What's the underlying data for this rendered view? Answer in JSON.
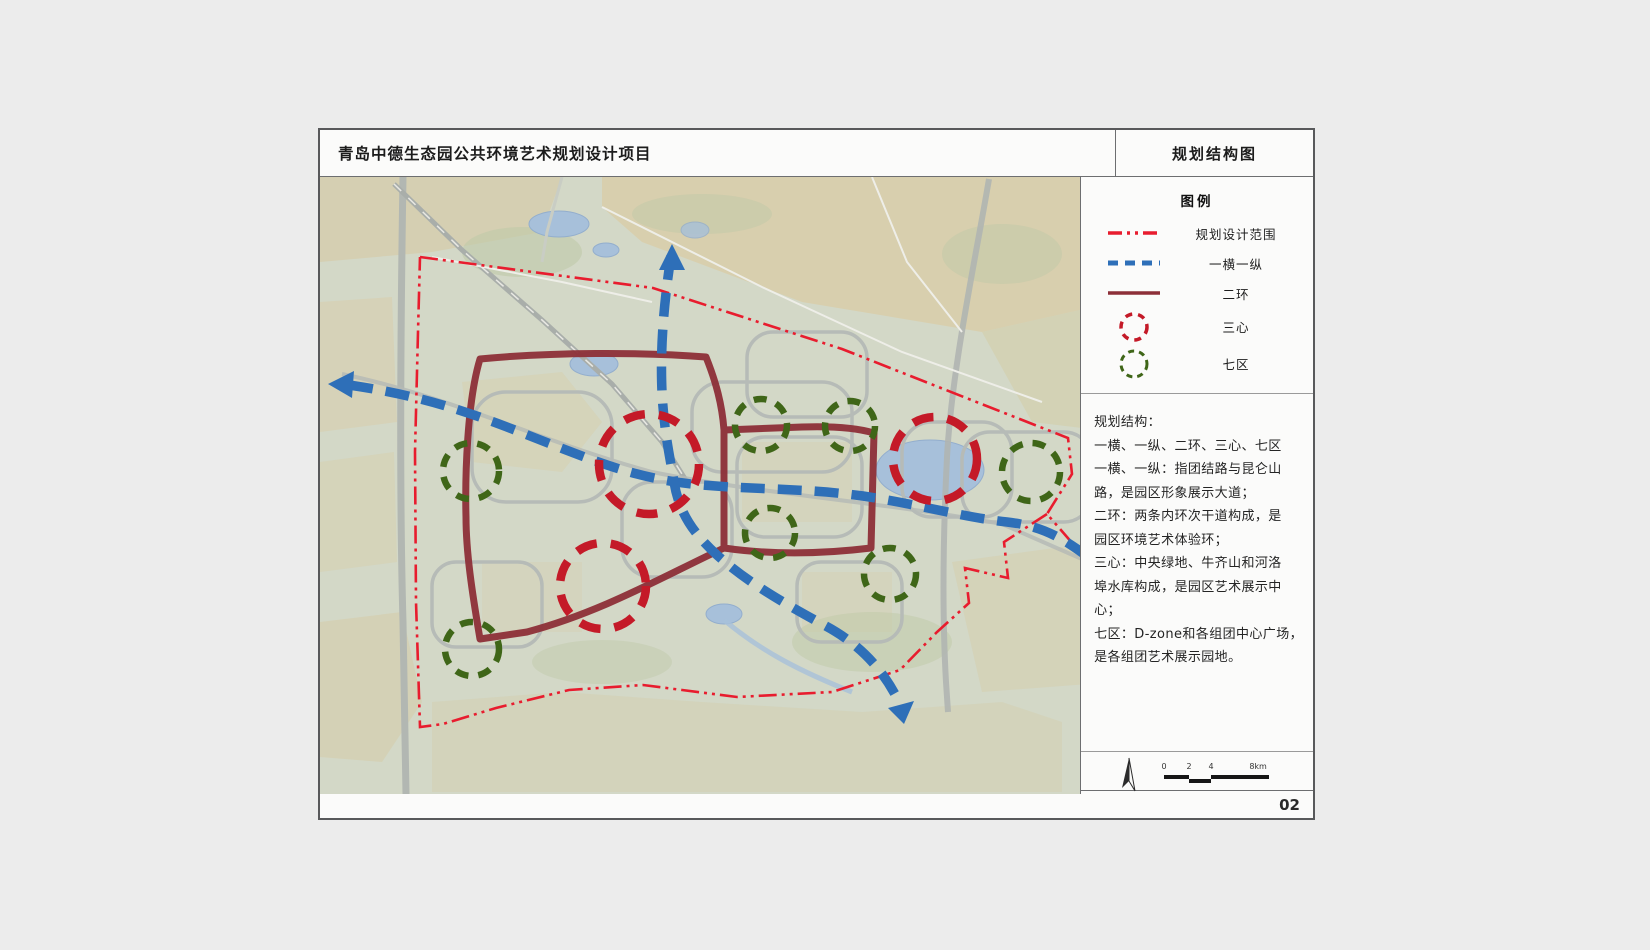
{
  "header": {
    "project_title": "青岛中德生态园公共环境艺术规划设计项目",
    "sheet_title": "规划结构图"
  },
  "legend": {
    "title": "图例",
    "items": [
      {
        "label": "规划设计范围",
        "symbol": "red-dashdot-line"
      },
      {
        "label": "一横一纵",
        "symbol": "blue-dashed-line"
      },
      {
        "label": "二环",
        "symbol": "maroon-solid-line"
      },
      {
        "label": "三心",
        "symbol": "red-dashed-circle"
      },
      {
        "label": "七区",
        "symbol": "green-dashed-circle"
      }
    ]
  },
  "notes": {
    "heading": "规划结构：",
    "lines": [
      "一横、一纵、二环、三心、七区",
      "一横、一纵：指团结路与昆仑山",
      "路，是园区形象展示大道；",
      "二环：两条内环次干道构成，是",
      "园区环境艺术体验环；",
      "三心：中央绿地、牛齐山和河洛",
      "埠水库构成，是园区艺术展示中",
      "心；",
      "七区：D-zone和各组团中心广场，",
      "是各组团艺术展示园地。"
    ]
  },
  "scale_bar": {
    "labels": [
      "0",
      "2",
      "4",
      "8km"
    ]
  },
  "page_number": "02",
  "colors": {
    "boundary_red": "#e81c2e",
    "route_blue": "#2e6fb8",
    "ring_maroon": "#8d2f38",
    "heart_red": "#c41a28",
    "zone_green": "#3f6618"
  },
  "map": {
    "three_hearts": [
      {
        "cx": 647,
        "cy": 462,
        "r": 50
      },
      {
        "cx": 601,
        "cy": 584,
        "r": 43
      },
      {
        "cx": 933,
        "cy": 457,
        "r": 42
      }
    ],
    "seven_zones": [
      {
        "cx": 469,
        "cy": 469,
        "r": 28
      },
      {
        "cx": 759,
        "cy": 423,
        "r": 26
      },
      {
        "cx": 848,
        "cy": 424,
        "r": 25
      },
      {
        "cx": 1029,
        "cy": 470,
        "r": 29
      },
      {
        "cx": 768,
        "cy": 531,
        "r": 25
      },
      {
        "cx": 888,
        "cy": 572,
        "r": 26
      },
      {
        "cx": 470,
        "cy": 647,
        "r": 27
      }
    ]
  }
}
